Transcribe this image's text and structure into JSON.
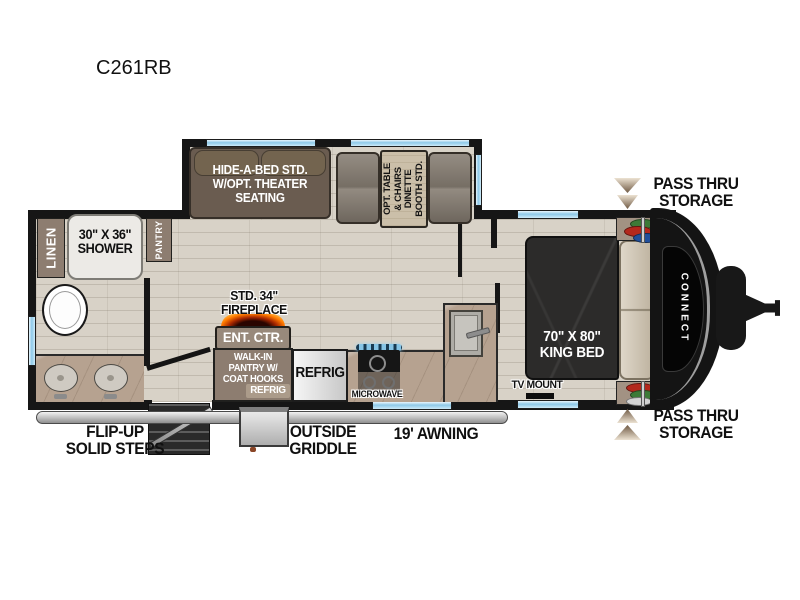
{
  "title": "C261RB",
  "brand_vertical": "CONNECT",
  "labels": {
    "linen": "LINEN",
    "shower": [
      "30\" X 36\"",
      "SHOWER"
    ],
    "pantry": "PANTRY",
    "sofa": [
      "HIDE-A-BED STD.",
      "W/OPT. THEATER",
      "SEATING"
    ],
    "dinette": [
      "OPT. TABLE",
      "& CHAIRS",
      "DINETTE",
      "BOOTH STD."
    ],
    "pass_thru_top": [
      "PASS THRU",
      "STORAGE"
    ],
    "pass_thru_bottom": [
      "PASS THRU",
      "STORAGE"
    ],
    "king_bed": [
      "70\" X 80\"",
      "KING BED"
    ],
    "tv_mount": "TV MOUNT",
    "fireplace": [
      "STD. 34\"",
      "FIREPLACE"
    ],
    "ent_ctr": "ENT. CTR.",
    "walk_in": [
      "WALK-IN",
      "PANTRY W/",
      "COAT HOOKS"
    ],
    "walk_in_refrig": "REFRIG",
    "refrig": "REFRIG",
    "microwave": "MICROWAVE",
    "flip_steps": [
      "FLIP-UP",
      "SOLID STEPS"
    ],
    "outside_griddle": [
      "OUTSIDE",
      "GRIDDLE"
    ],
    "awning": "19' AWNING"
  },
  "colors": {
    "wall": "#161616",
    "floor": "#d8d2c7",
    "cabinet_brown": "#8d7d70",
    "sofa_taupe": "#6a5c50",
    "bench_gray": "#867d72",
    "table_beige": "#cbbfa9",
    "window_blue": "#8ec9e8",
    "bed_dark": "#2c2b2a",
    "pillow_tan": "#cdc1ac",
    "counter_tan": "#b6a290",
    "arrow_tan": "#ece2d2",
    "arrow_brown": "#6f5943",
    "fireplace_orange": "#ff8800",
    "awning_gray": "#c9c9c9"
  }
}
